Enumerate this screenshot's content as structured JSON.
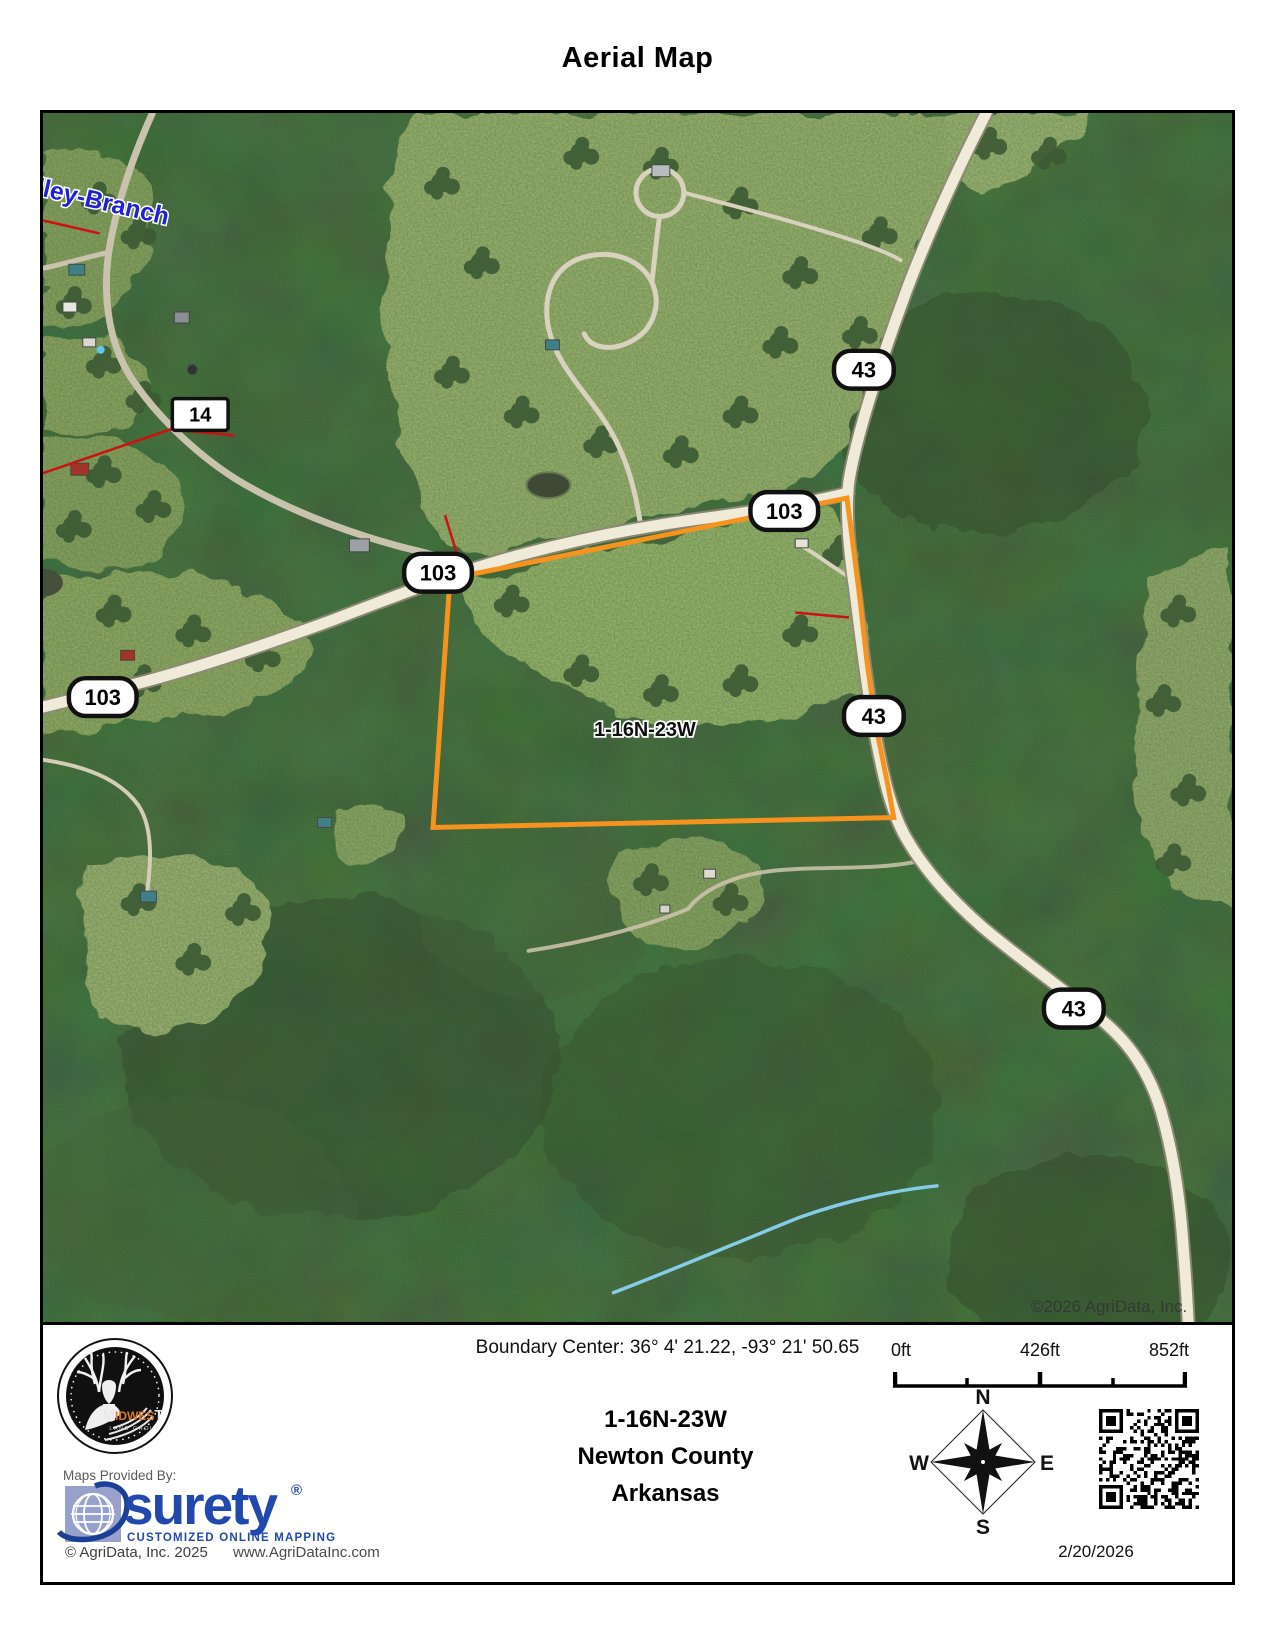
{
  "title": "Aerial Map",
  "map": {
    "road_name_label": "lley-Branch",
    "parcel_label": "1-16N-23W",
    "watermark": "©2026 AgriData, Inc.",
    "shields": [
      {
        "label": "14"
      },
      {
        "label": "43"
      },
      {
        "label": "103"
      },
      {
        "label": "103"
      },
      {
        "label": "103"
      },
      {
        "label": "43"
      },
      {
        "label": "43"
      }
    ]
  },
  "footer": {
    "boundary_center": "Boundary Center: 36° 4' 21.22,  -93° 21' 50.65",
    "parcel_id": "1-16N-23W",
    "county": "Newton County",
    "state": "Arkansas",
    "provider_label": "Maps Provided By:",
    "surety": {
      "wordmark": "surety",
      "registered": "®",
      "tagline": "CUSTOMIZED ONLINE MAPPING"
    },
    "copyright": "© AgriData, Inc. 2025",
    "website": "www.AgriDataInc.com",
    "scale_bar": {
      "start": "0ft",
      "middle": "426ft",
      "end": "852ft"
    },
    "compass": {
      "north": "N",
      "east": "E",
      "south": "S",
      "west": "W"
    },
    "date": "2/20/2026",
    "midwest_logo": {
      "first": "M",
      "middle": "IDWES",
      "last": "T",
      "subtitle": "LAND GROUP"
    }
  },
  "colors": {
    "parcel_boundary": "#f6921e",
    "road_label": "#2020d8",
    "surety_blue": "#2148ad",
    "midwest_orange": "#d97a2b"
  }
}
